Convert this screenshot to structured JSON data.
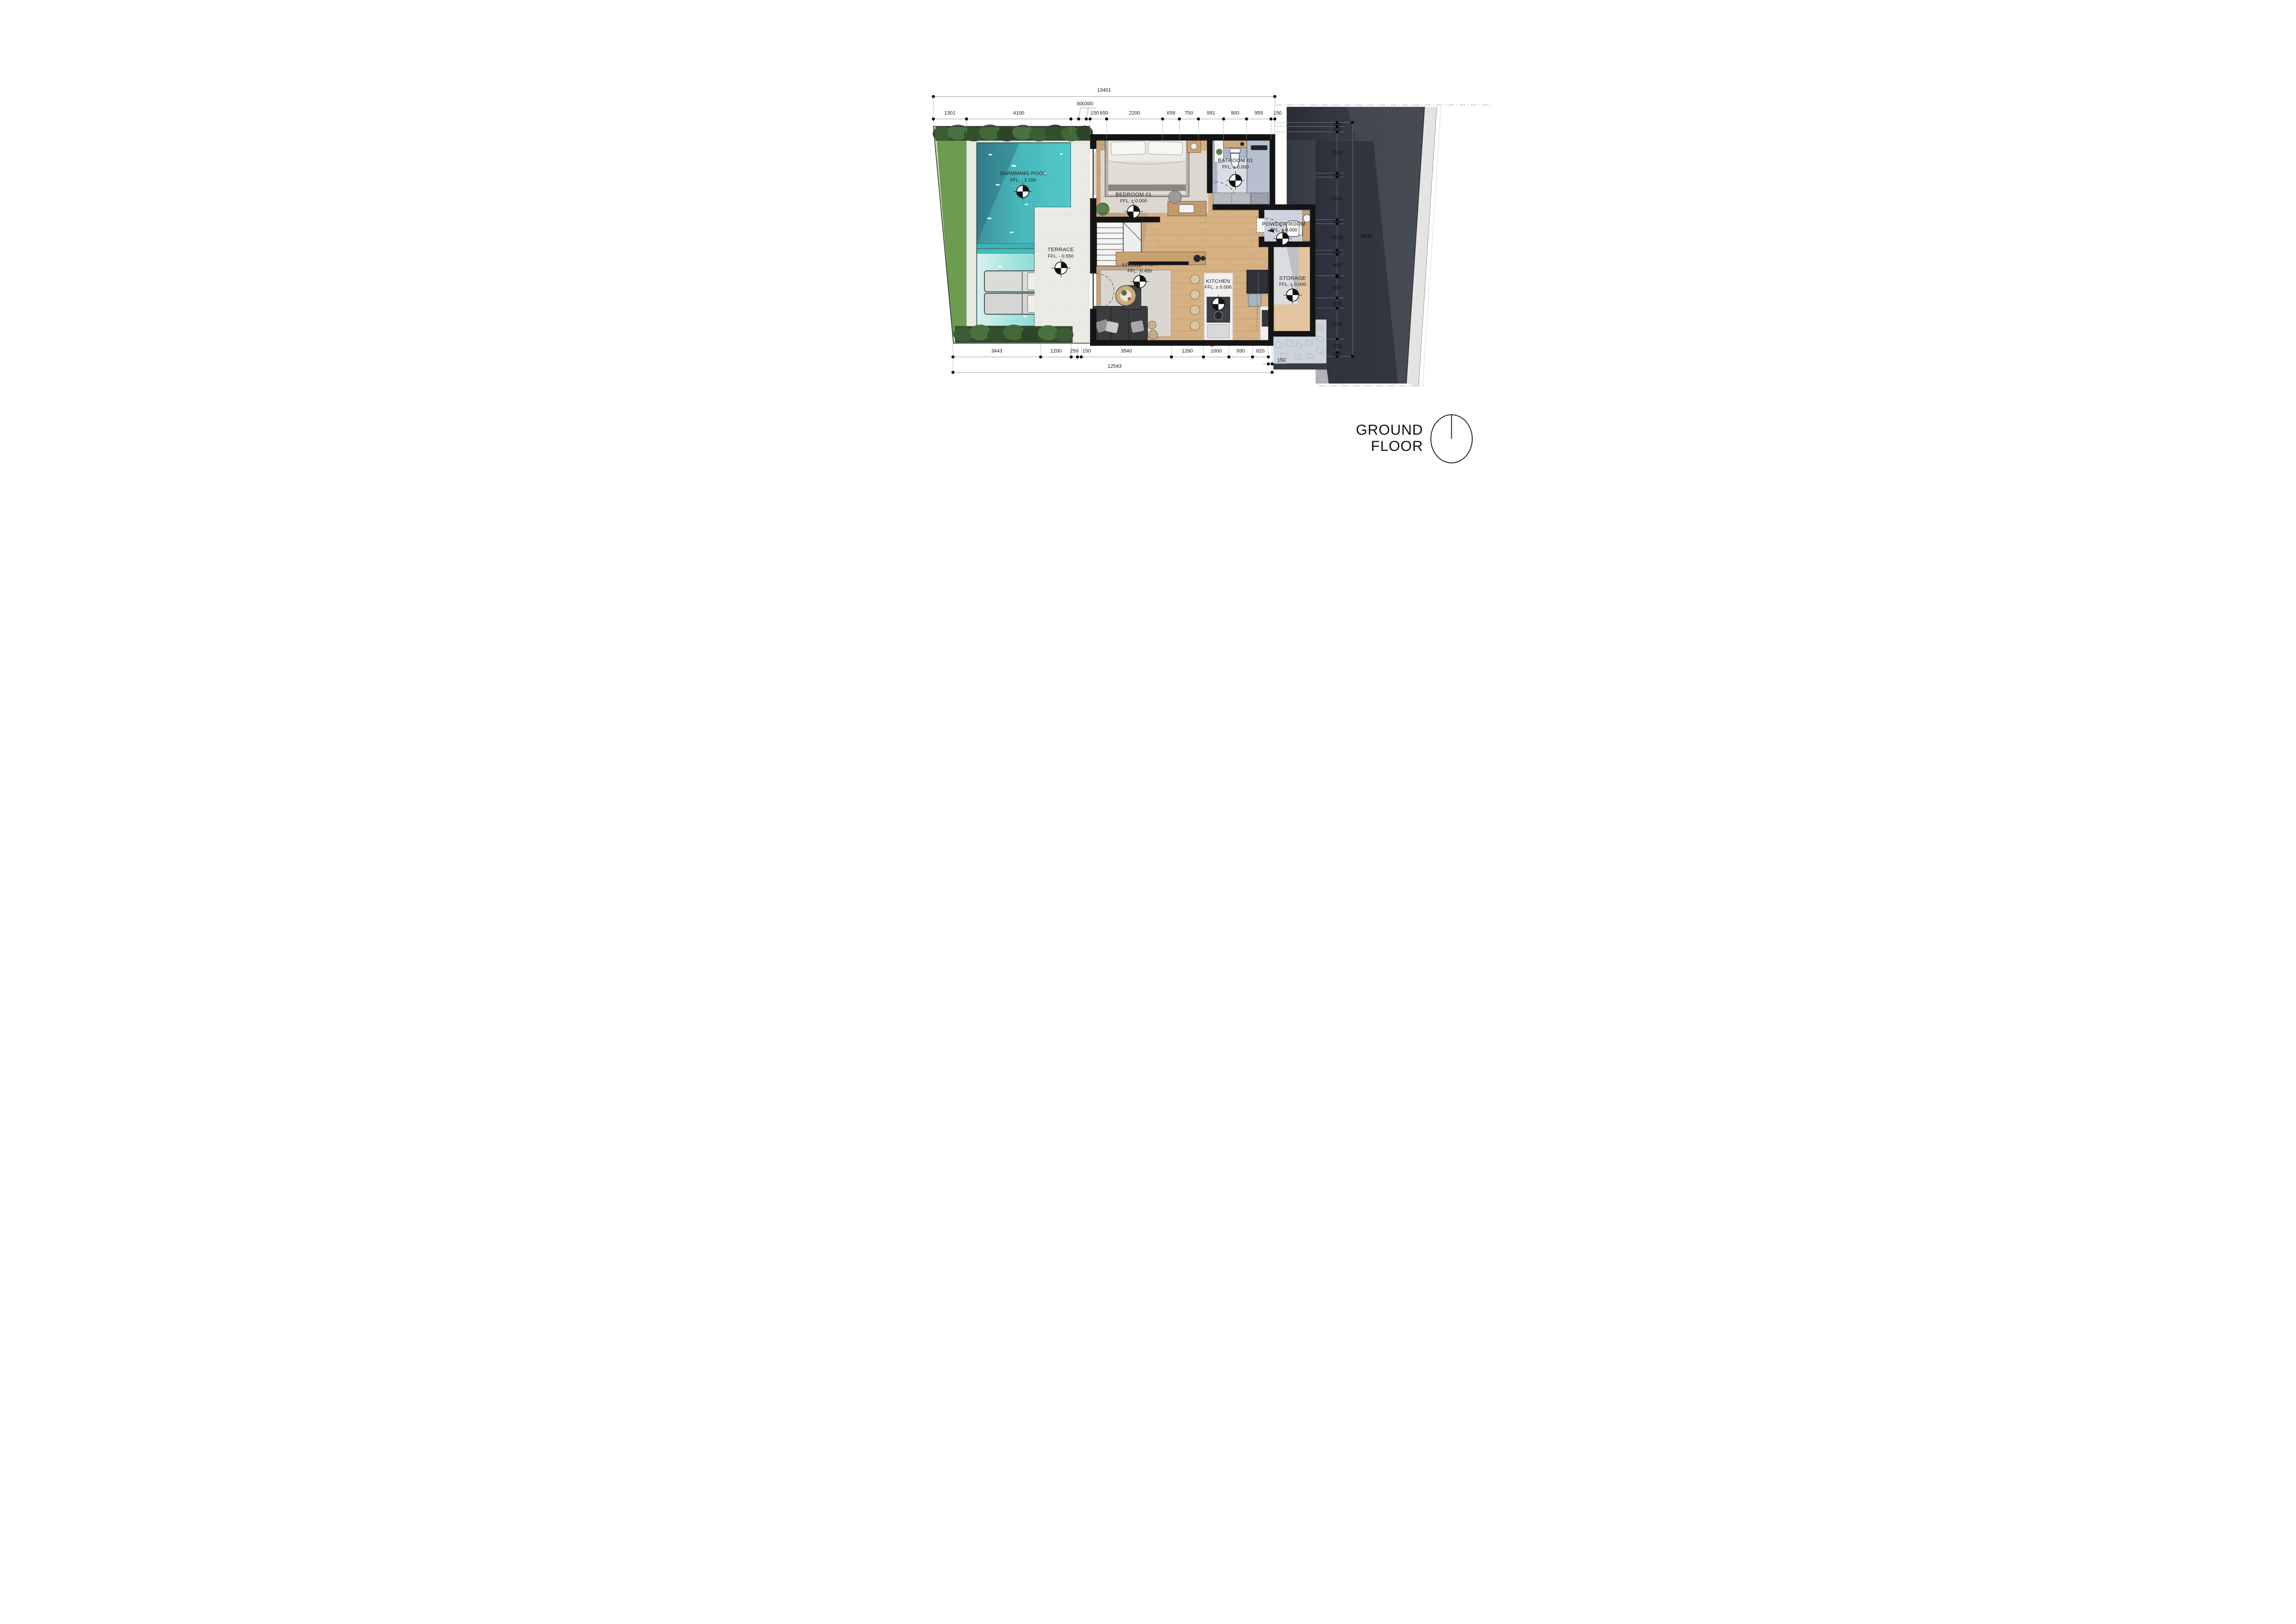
{
  "plan": {
    "title_line1": "GROUND",
    "title_line2": "FLOOR"
  },
  "rooms": {
    "swimming_pool": {
      "name": "SWIMMING POOL",
      "ffl": "FFL. - 2.150"
    },
    "terrace": {
      "name": "TERRACE",
      "ffl": "FFL. - 0.550"
    },
    "bedroom": {
      "name": "BEDROOM 01",
      "ffl": "FFL. ± 0.000"
    },
    "bathroom": {
      "name": "BATROOM 01",
      "ffl": "FFL. ± 0.000"
    },
    "living": {
      "name": "LIVING AREA",
      "ffl": "FFL. -0.450"
    },
    "kitchen": {
      "name": "KITCHEN",
      "ffl": "FFL. ± 0.000"
    },
    "powder": {
      "name": "POWDER ROOM",
      "ffl": "FFL. ± 0.000"
    },
    "storage": {
      "name": "STORAGE",
      "ffl": "FFL. ± 0.000"
    }
  },
  "stairs": {
    "label": "UP"
  },
  "appliances": {
    "refrigerator": "REFRIGERATOR (by MODENA)",
    "water_dispenser": "WATER DISPENSER (by MODENA)"
  },
  "dimensions": {
    "top_overall": "13401",
    "top_leader": "300300",
    "top": [
      "1301",
      "4100",
      "150",
      "650",
      "2200",
      "659",
      "750",
      "991",
      "900",
      "959",
      "150"
    ],
    "bottom": [
      "3443",
      "1200",
      "250",
      "150",
      "3540",
      "1260",
      "1000",
      "930",
      "620"
    ],
    "bottom_offset": "150",
    "bottom_overall": "12543",
    "right": [
      "150",
      "200",
      "1550",
      "150",
      "1600",
      "150",
      "1000",
      "150",
      "800",
      "40",
      "800",
      "380",
      "1168",
      "500",
      "150"
    ],
    "right_overall": "8638"
  },
  "colors": {
    "pool_deep": "#4fc6c8",
    "pool_shallow": "#a7e2df",
    "lawn": "#6d9b50",
    "hedge": "#3b5d35",
    "paving": "#e9e7e2",
    "wall": "#141414",
    "wood_floor": "#d6b183",
    "bath_tile": "#a9b4c6",
    "dark_site": "#42464d",
    "text": "#1c1c1c"
  }
}
